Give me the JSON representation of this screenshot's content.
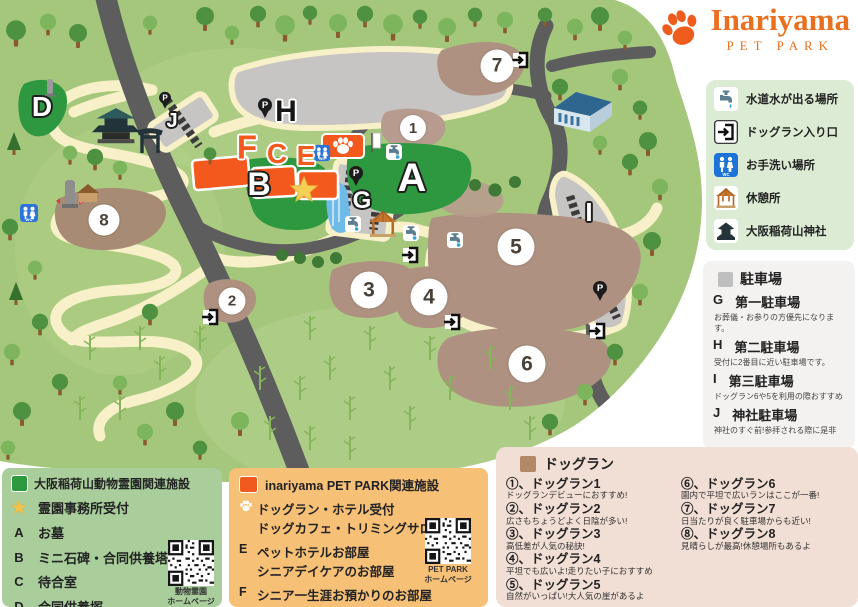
{
  "colors": {
    "brand_orange": "#EE5D1E",
    "cemetery_green": "#2E9A40",
    "parking_gray": "#BFBFBF",
    "dogrun_brown": "#B28A69"
  },
  "logo": {
    "title": "Inariyama",
    "subtitle": "PET PARK"
  },
  "facility_legend": {
    "items": [
      {
        "icon": "faucet-icon",
        "label": "水道水が出る場所"
      },
      {
        "icon": "dogrun-entrance-icon",
        "label": "ドッグラン入り口"
      },
      {
        "icon": "restroom-icon",
        "label": "お手洗い場所"
      },
      {
        "icon": "rest-area-icon",
        "label": "休憩所"
      },
      {
        "icon": "shrine-icon",
        "label": "大阪稲荷山神社"
      }
    ]
  },
  "parking_legend": {
    "title": "駐車場",
    "items": [
      {
        "code": "G",
        "name": "第一駐車場",
        "note": "お葬儀・お参りの方優先になります。"
      },
      {
        "code": "H",
        "name": "第二駐車場",
        "note": "受付に2番目に近い駐車場です。"
      },
      {
        "code": "I",
        "name": "第三駐車場",
        "note": "ドッグラン6や5を利用の際おすすめ"
      },
      {
        "code": "J",
        "name": "神社駐車場",
        "note": "神社のすぐ前!参拝される際に是非"
      }
    ]
  },
  "dogrun_legend": {
    "title": "ドッグラン",
    "items": [
      {
        "title": "①、ドッグラン1",
        "note": "ドッグランデビューにおすすめ!"
      },
      {
        "title": "②、ドッグラン2",
        "note": "広さもちょうどよく日陰が多い!"
      },
      {
        "title": "③、ドッグラン3",
        "note": "高低差が人気の秘訣!"
      },
      {
        "title": "④、ドッグラン4",
        "note": "平坦でも広いよ!走りたい子におすすめ"
      },
      {
        "title": "⑤、ドッグラン5",
        "note": "自然がいっぱい!大人気の崖があるよ"
      },
      {
        "title": "⑥、ドッグラン6",
        "note": "園内で平坦で広いランはここが一番!"
      },
      {
        "title": "⑦、ドッグラン7",
        "note": "日当たりが良く駐車場からも近い!"
      },
      {
        "title": "⑧、ドッグラン8",
        "note": "見晴らしが最高!休憩場所もあるよ"
      }
    ]
  },
  "cemetery_legend": {
    "title": "大阪稲荷山動物霊園関連施設",
    "items": [
      {
        "code": "★",
        "name": "霊園事務所受付"
      },
      {
        "code": "A",
        "name": "お墓"
      },
      {
        "code": "B",
        "name": "ミニ石碑・合同供養塔"
      },
      {
        "code": "C",
        "name": "待合室"
      },
      {
        "code": "D",
        "name": "合同供養塚"
      }
    ],
    "qr_caption_line1": "動物霊園",
    "qr_caption_line2": "ホームページ"
  },
  "petpark_legend": {
    "title": "inariyama PET PARK関連施設",
    "items": [
      {
        "code": "",
        "name": "ドッグラン・ホテル受付",
        "name2": "ドッグカフェ・トリミングサロン"
      },
      {
        "code": "E",
        "name": "ペットホテルお部屋",
        "name2": "シニアデイケアのお部屋"
      },
      {
        "code": "F",
        "name": "シニア一生涯お預かりのお部屋",
        "name2": ""
      }
    ],
    "qr_caption_line1": "PET PARK",
    "qr_caption_line2": "ホームページ"
  },
  "map": {
    "areas": {
      "n1": "1",
      "n2": "2",
      "n3": "3",
      "n4": "4",
      "n5": "5",
      "n6": "6",
      "n7": "7",
      "n8": "8"
    },
    "letters": {
      "A": "A",
      "B": "B",
      "C": "C",
      "D": "D",
      "E": "E",
      "F": "F",
      "G": "G",
      "H": "H",
      "I": "I",
      "J": "J"
    }
  }
}
